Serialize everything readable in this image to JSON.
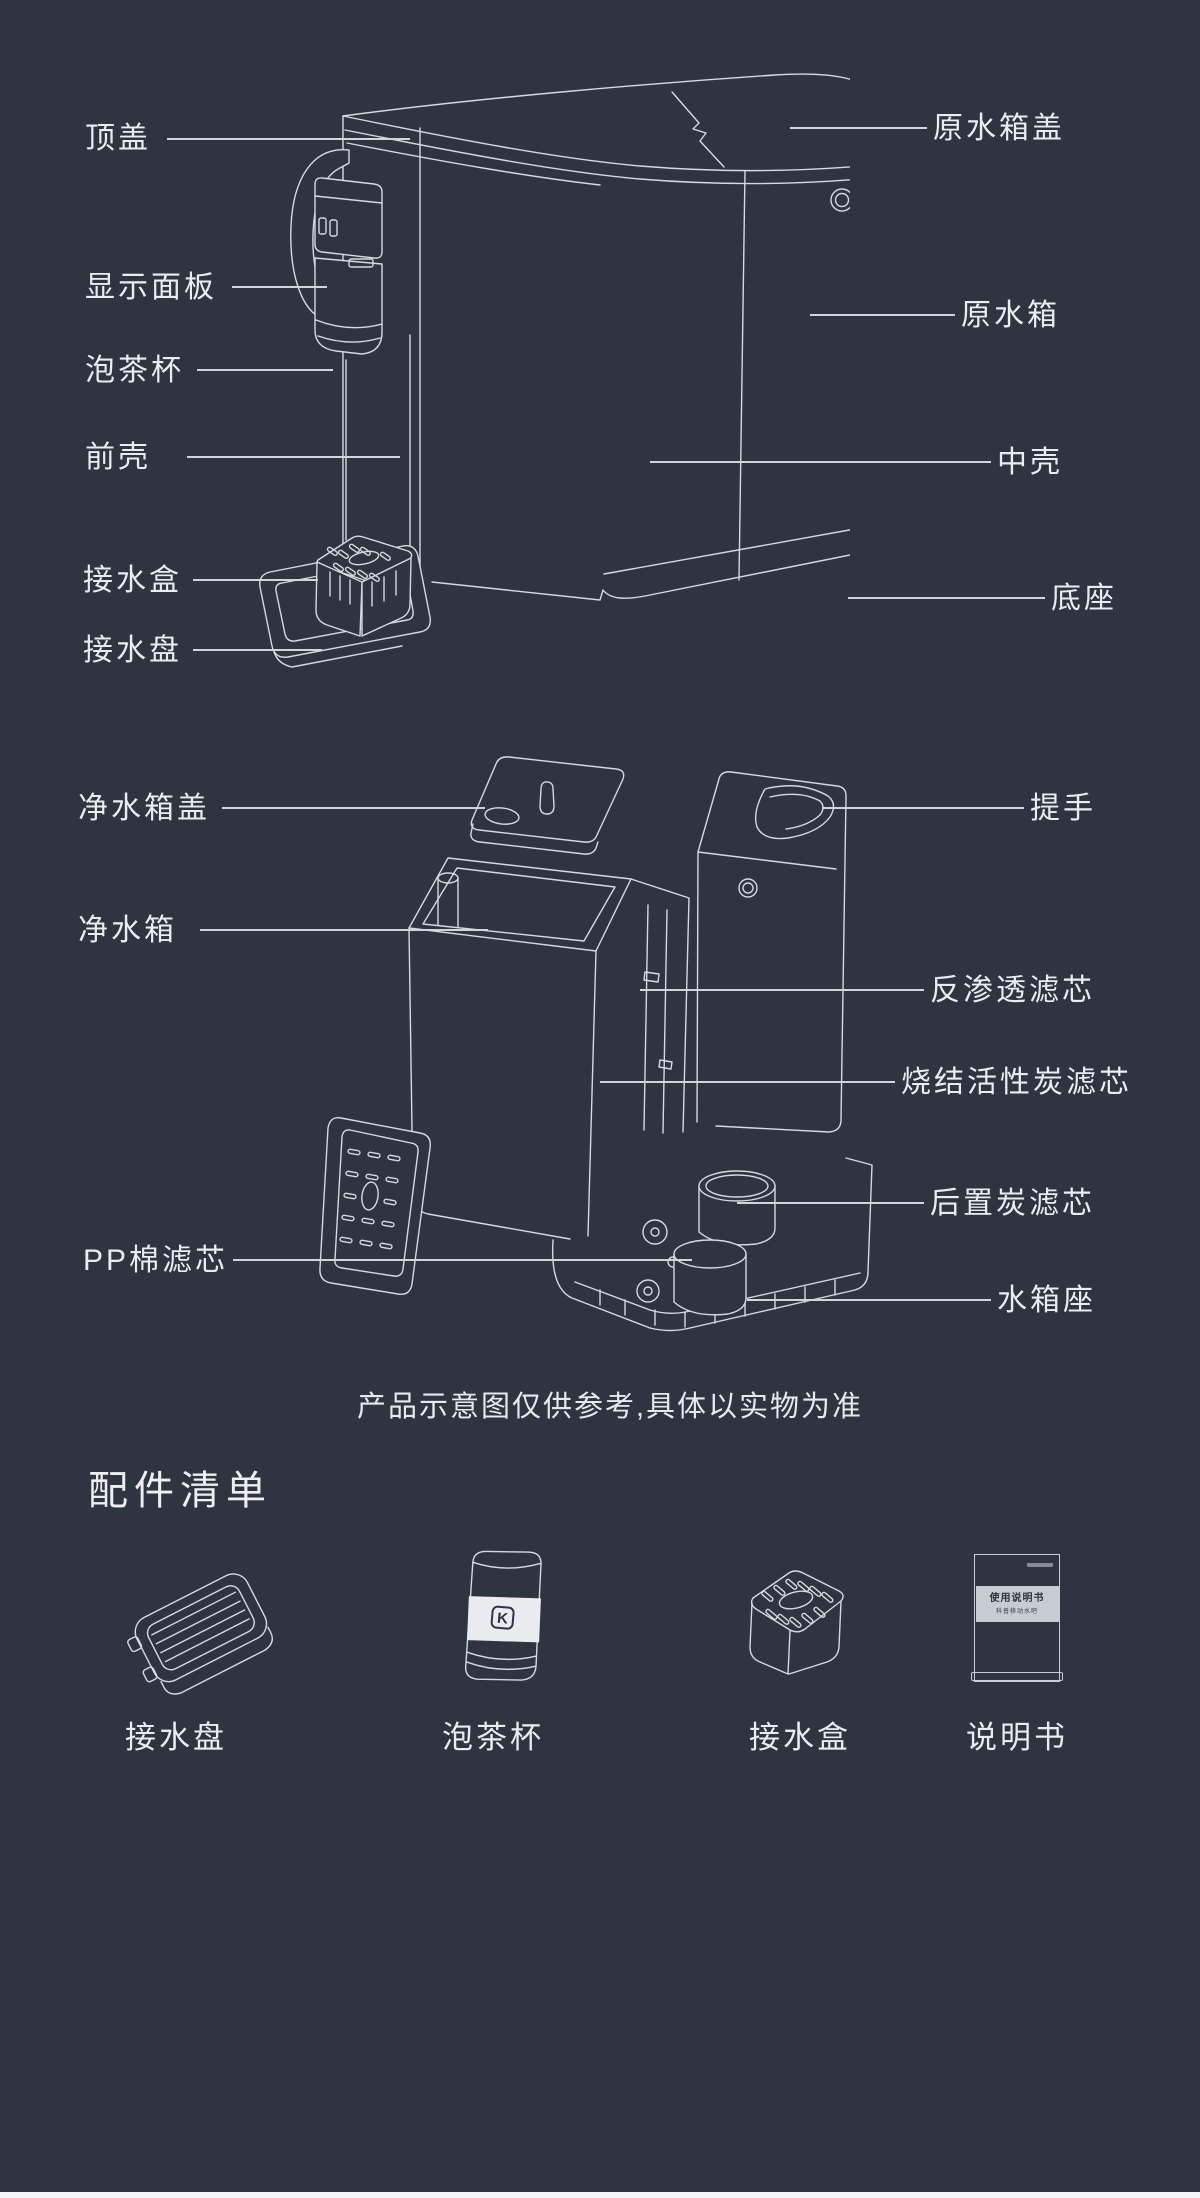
{
  "page": {
    "background_color": "#2E3440",
    "line_color": "#D5DAE0",
    "text_color": "#E9ECF0",
    "bottom_strip_color": "#F5F6F7"
  },
  "diagram1": {
    "name": "assembled-water-bar",
    "left_labels": [
      "顶盖",
      "显示面板",
      "泡茶杯",
      "前壳",
      "接水盒",
      "接水盘"
    ],
    "right_labels": [
      "原水箱盖",
      "原水箱",
      "中壳",
      "底座"
    ]
  },
  "diagram2": {
    "name": "exploded-water-bar",
    "left_labels": [
      "净水箱盖",
      "净水箱",
      "PP棉滤芯"
    ],
    "right_labels": [
      "提手",
      "反渗透滤芯",
      "烧结活性炭滤芯",
      "后置炭滤芯",
      "水箱座"
    ]
  },
  "disclaimer": "产品示意图仅供参考,具体以实物为准",
  "accessories": {
    "heading": "配件清单",
    "items": [
      "接水盘",
      "泡茶杯",
      "接水盒",
      "说明书"
    ],
    "cup_logo": "K",
    "manual_cover": {
      "title": "使用说明书",
      "subtitle": "科普移动水吧"
    }
  }
}
